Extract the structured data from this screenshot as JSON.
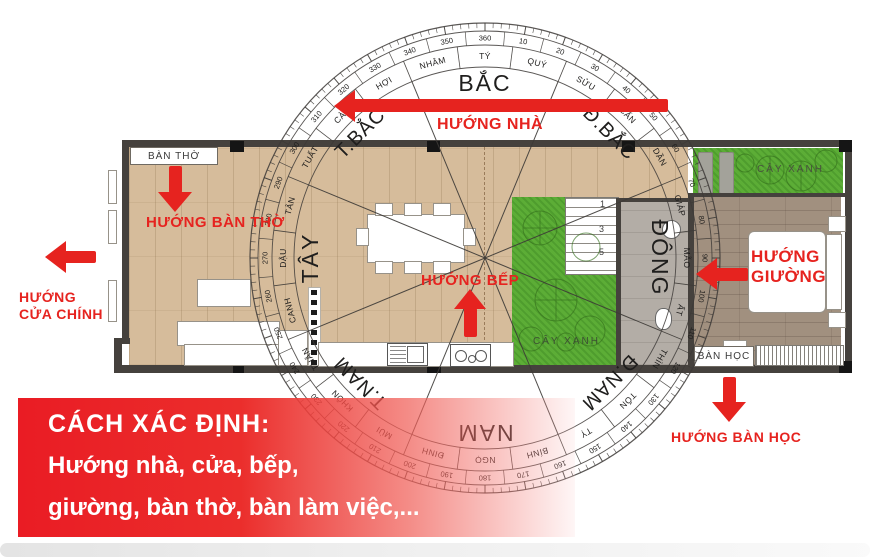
{
  "banner": {
    "title": "CÁCH XÁC ĐỊNH:",
    "line2": "Hướng nhà, cửa, bếp,",
    "line3": "giường, bàn thờ, bàn làm việc,..."
  },
  "annotations": {
    "house": "HƯỚNG NHÀ",
    "altar": "HƯỚNG BÀN THỜ",
    "main_door_1": "HƯỚNG",
    "main_door_2": "CỬA CHÍNH",
    "kitchen": "HƯỚNG BẾP",
    "bed_1": "HƯỚNG",
    "bed_2": "GIƯỜNG",
    "desk": "HƯỚNG BÀN HỌC"
  },
  "plan_labels": {
    "altar": "BÀN THỜ",
    "green_center": "CÂY XANH",
    "green_top_right": "CÂY XANH",
    "desk": "BÀN HỌC",
    "stairs": [
      "1",
      "3",
      "5"
    ]
  },
  "compass": {
    "cardinals": [
      {
        "label": "BẮC",
        "angle": 0
      },
      {
        "label": "Đ.BẮC",
        "angle": 45
      },
      {
        "label": "ĐÔNG",
        "angle": 90
      },
      {
        "label": "Đ.NAM",
        "angle": 135
      },
      {
        "label": "NAM",
        "angle": 180
      },
      {
        "label": "T.NAM",
        "angle": 225
      },
      {
        "label": "TÂY",
        "angle": 270
      },
      {
        "label": "T.BẮC",
        "angle": 315
      }
    ],
    "mountains": [
      {
        "label": "TÝ",
        "angle": 0
      },
      {
        "label": "QUÝ",
        "angle": 15
      },
      {
        "label": "SỬU",
        "angle": 30
      },
      {
        "label": "CẤN",
        "angle": 45
      },
      {
        "label": "DẦN",
        "angle": 60
      },
      {
        "label": "GIÁP",
        "angle": 75
      },
      {
        "label": "MÃO",
        "angle": 90
      },
      {
        "label": "ẤT",
        "angle": 105
      },
      {
        "label": "THÌN",
        "angle": 120
      },
      {
        "label": "TỐN",
        "angle": 135
      },
      {
        "label": "TỴ",
        "angle": 150
      },
      {
        "label": "BÍNH",
        "angle": 165
      },
      {
        "label": "NGỌ",
        "angle": 180
      },
      {
        "label": "ĐINH",
        "angle": 195
      },
      {
        "label": "MÙI",
        "angle": 210
      },
      {
        "label": "KHÔN",
        "angle": 225
      },
      {
        "label": "THÂN",
        "angle": 240
      },
      {
        "label": "CANH",
        "angle": 255
      },
      {
        "label": "DẬU",
        "angle": 270
      },
      {
        "label": "TÂN",
        "angle": 285
      },
      {
        "label": "TUẤT",
        "angle": 300
      },
      {
        "label": "CÀN",
        "angle": 315
      },
      {
        "label": "HỢI",
        "angle": 330
      },
      {
        "label": "NHÂM",
        "angle": 345
      }
    ],
    "degree_labels": [
      "10",
      "20",
      "30",
      "40",
      "50",
      "60",
      "70",
      "80",
      "90",
      "100",
      "110",
      "120",
      "130",
      "140",
      "150",
      "160",
      "170",
      "180",
      "190",
      "200",
      "210",
      "220",
      "230",
      "240",
      "250",
      "260",
      "270",
      "280",
      "290",
      "300",
      "310",
      "320",
      "330",
      "340",
      "350",
      "360"
    ]
  },
  "colors": {
    "annotation_red": "#e6231f",
    "banner_red": "#ea1c24",
    "wall_gray": "#45413d",
    "wood_light": "#d6bc9b",
    "wood_dark": "#a1907f",
    "tile_gray": "#b3ada6",
    "grass_green": "#5cad36"
  }
}
